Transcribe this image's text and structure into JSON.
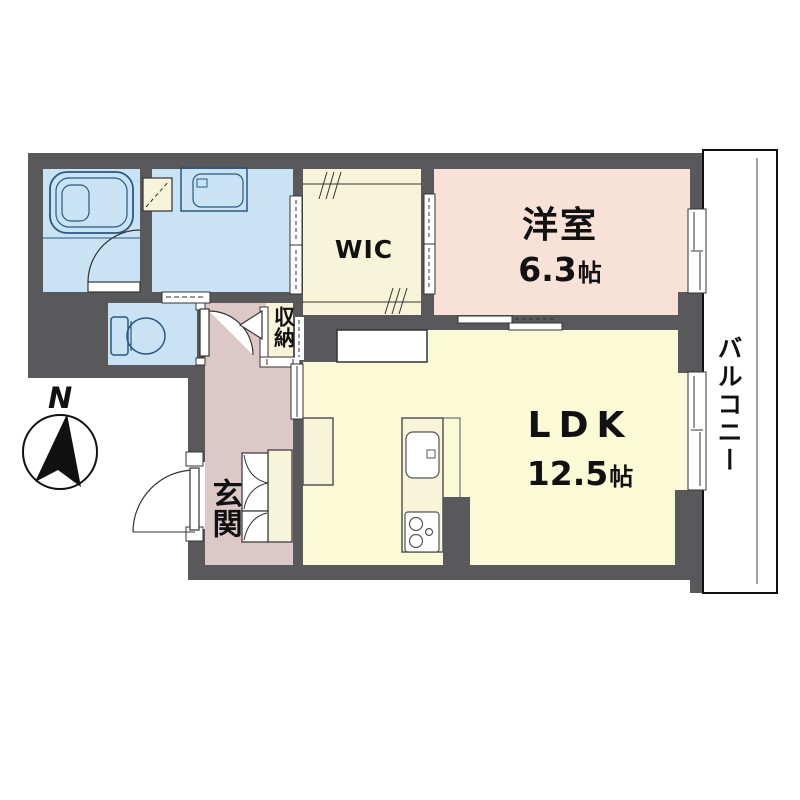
{
  "plan": {
    "rooms": {
      "western_room": {
        "label": "洋室",
        "size": "6.3",
        "unit": "帖"
      },
      "ldk": {
        "label": "LDK",
        "size": "12.5",
        "unit": "帖"
      },
      "wic": {
        "label": "WIC"
      },
      "entrance": {
        "label": "玄関"
      },
      "storage": {
        "label": "収納"
      },
      "balcony": {
        "label": "バルコニー"
      }
    },
    "compass": {
      "north_label": "N"
    }
  },
  "colors": {
    "wall": "#59585a",
    "wet_area": "#c9e3f5",
    "room_pink": "#f8e2d8",
    "room_yellow": "#fbfad7",
    "room_cream": "#f8f4da",
    "hallway_pink": "#dbc8c7",
    "fixture_blue": "#2a5880",
    "line_dark": "#333333"
  }
}
